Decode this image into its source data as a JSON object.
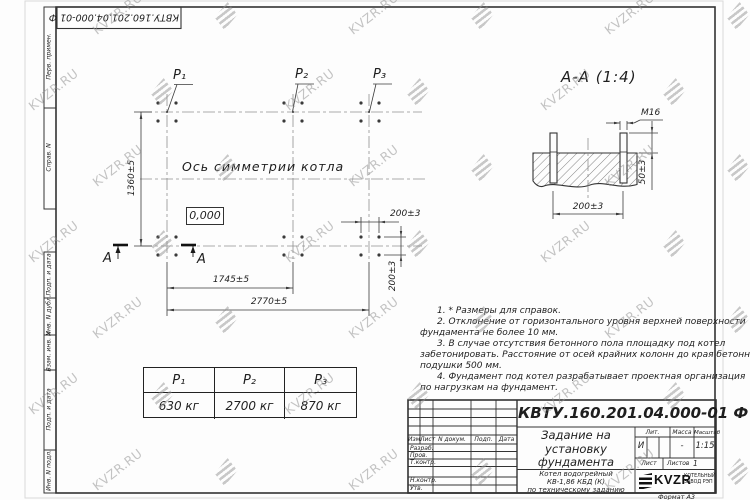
{
  "colors": {
    "line": "#333333",
    "watermark": "#949494"
  },
  "stamp_top": "КВТУ.160.201.04.000-01 Ф",
  "margin_labels": {
    "perv_primen": "Перв. примен.",
    "sprav_n": "Справ. N",
    "podp_data_1": "Подп. и дата",
    "inv_dubl": "Инв. N дубл.",
    "vzam_inv": "Взам. инв. N",
    "podp_data_2": "Подп. и дата",
    "inv_podl": "Инв. N подл."
  },
  "plan": {
    "p1": "P₁",
    "p2": "P₂",
    "p3": "P₃",
    "axis_label": "Ось симметрии котла",
    "elevation": "0,000",
    "dim_height": "1360±5",
    "dim_mid": "1745±5",
    "dim_full": "2770±5",
    "dim_bolt_h": "200±3",
    "dim_bolt_v": "200±3",
    "cut_letter_left": "А",
    "cut_letter_right": "А"
  },
  "section": {
    "title": "А-А (1:4)",
    "dim_thread": "М16",
    "dim_protrusion": "50±3",
    "dim_spacing": "200±3"
  },
  "notes": {
    "lines": [
      "1. * Размеры для справок.",
      "2. Отклонение от горизонтального уровня верхней поверхности",
      "фундамента не более 10 мм.",
      "3. В случае отсутствия бетонного пола площадку под котел",
      "забетонировать. Расстояние от осей крайних колонн до края бетонной",
      "подушки 500 мм.",
      "4. Фундамент под котел разрабатывает проектная организация",
      "по нагрузкам на фундамент."
    ]
  },
  "load_table": {
    "headers": [
      "P₁",
      "P₂",
      "P₃"
    ],
    "values": [
      "630 кг",
      "2700 кг",
      "870 кг"
    ]
  },
  "title_block": {
    "designation": "КВТУ.160.201.04.000-01 Ф",
    "doc_title_1": "Задание на",
    "doc_title_2": "установку",
    "doc_title_3": "фундамента",
    "product_1": "Котел водогрейный",
    "product_2": "КВ-1,86 КБД (К)",
    "product_3": "по техническому заданию",
    "col_izm": "Изм.",
    "col_list": "Лист",
    "col_ndok": "N докум.",
    "col_podp": "Подп.",
    "col_data": "Дата",
    "row_razrab": "Разраб.",
    "row_prov": "Пров.",
    "row_tkontr": "Т.контр.",
    "row_nkontr": "Н.контр.",
    "row_utv": "Утв.",
    "lit_label": "Лит.",
    "lit_value": "И",
    "mass_label": "Масса",
    "mass_value": "-",
    "scale_label": "Масштаб",
    "scale_value": "1:15",
    "sheet_label": "Лист",
    "sheets_label": "Листов",
    "sheets_value": "1",
    "company": "KVZR",
    "company_sub1": "КОТЕЛЬНЫЙ",
    "company_sub2": "ЗАВОД РЭП",
    "format": "Формат А3"
  },
  "watermark": {
    "text": "KVZR.RU"
  }
}
